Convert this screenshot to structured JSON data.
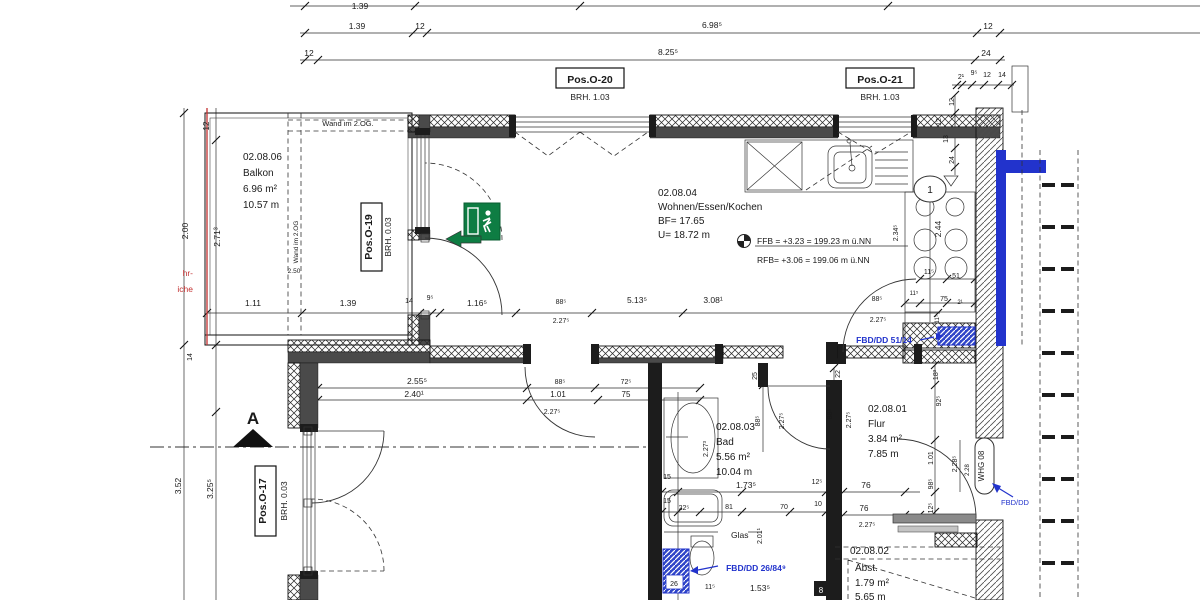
{
  "colors": {
    "black": "#1a1a1a",
    "blue": "#2233cc",
    "red": "#c23030",
    "green": "#0e7d43",
    "white": "#ffffff",
    "wall_dark": "#4a4a4a"
  },
  "rooms": {
    "balkon": {
      "id": "02.08.06",
      "name": "Balkon",
      "area": "6.96 m²",
      "perimeter": "10.57 m"
    },
    "wohnen": {
      "id": "02.08.04",
      "name": "Wohnen/Essen/Kochen",
      "bf": "BF= 17.65",
      "u": "U= 18.72 m"
    },
    "bad": {
      "id": "02.08.03",
      "name": "Bad",
      "area": "5.56 m²",
      "perimeter": "10.04 m"
    },
    "flur": {
      "id": "02.08.01",
      "name": "Flur",
      "area": "3.84 m²",
      "perimeter": "7.85 m"
    },
    "abst": {
      "id": "02.08.02",
      "name": "Abst.",
      "area": "1.79 m²",
      "perimeter": "5.65 m"
    }
  },
  "levels": {
    "ffb": "FFB = +3.23 = 199.23 m ü.NN",
    "rfb": "RFB= +3.06 = 199.06 m ü.NN"
  },
  "pos": {
    "o20": {
      "label": "Pos.O-20",
      "brh": "BRH. 1.03"
    },
    "o21": {
      "label": "Pos.O-21",
      "brh": "BRH. 1.03"
    },
    "o19": {
      "label": "Pos.O-19",
      "brh": "BRH. 0.03"
    },
    "o17": {
      "label": "Pos.O-17",
      "brh": "BRH. 0.03"
    }
  },
  "tags": {
    "whg": "WHG 08",
    "section": "A",
    "glas": "Glas",
    "wand2og_h": "Wand im 2.OG.",
    "wand2og_v": "Wand im 2.OG",
    "red1": "hr-",
    "red2": "iche",
    "detail": "1",
    "chip26": "26",
    "chip8": "8"
  },
  "blue_labels": {
    "fbd1": "FBD/DD 51/14",
    "fbd2": "FBD/DD 26/84⁹",
    "fbd3": "FBD/DD"
  },
  "labels": [
    {
      "t": "1.39",
      "x": 360,
      "y": 9
    },
    {
      "t": "1.39",
      "x": 357,
      "y": 29
    },
    {
      "t": "12",
      "x": 420,
      "y": 29
    },
    {
      "t": "6.98⁵",
      "x": 712,
      "y": 28
    },
    {
      "t": "12",
      "x": 988,
      "y": 29
    },
    {
      "t": "12",
      "x": 309,
      "y": 56
    },
    {
      "t": "8.25⁵",
      "x": 668,
      "y": 55
    },
    {
      "t": "24",
      "x": 986,
      "y": 56
    },
    {
      "t": "2¹",
      "x": 961,
      "y": 79,
      "s": 7
    },
    {
      "t": "9⁵",
      "x": 974,
      "y": 75,
      "s": 7
    },
    {
      "t": "12",
      "x": 987,
      "y": 77,
      "s": 7
    },
    {
      "t": "14",
      "x": 1002,
      "y": 77,
      "s": 7
    },
    {
      "t": "12",
      "x": 954,
      "y": 102,
      "r": -90,
      "s": 7
    },
    {
      "t": "12",
      "x": 941,
      "y": 122,
      "r": -90,
      "s": 7
    },
    {
      "t": "13",
      "x": 948,
      "y": 139,
      "r": -90,
      "s": 7
    },
    {
      "t": "24",
      "x": 954,
      "y": 160,
      "r": -90,
      "s": 7
    },
    {
      "t": "12",
      "x": 209,
      "y": 126,
      "r": -90,
      "s": 8
    },
    {
      "t": "2.71³",
      "x": 220,
      "y": 237,
      "r": -90
    },
    {
      "t": "2.00",
      "x": 188,
      "y": 231,
      "r": -90
    },
    {
      "t": "14",
      "x": 192,
      "y": 357,
      "r": -90,
      "s": 7
    },
    {
      "t": "3.52",
      "x": 181,
      "y": 486,
      "r": -90
    },
    {
      "t": "3.25⁵",
      "x": 213,
      "y": 489,
      "r": -90
    },
    {
      "t": "2.50",
      "x": 294,
      "y": 273,
      "s": 6.5
    },
    {
      "t": "1.11",
      "x": 253,
      "y": 306
    },
    {
      "t": "1.39",
      "x": 348,
      "y": 306
    },
    {
      "t": "14",
      "x": 409,
      "y": 303,
      "s": 7
    },
    {
      "t": "9⁵",
      "x": 430,
      "y": 300,
      "s": 7
    },
    {
      "t": "1.16⁵",
      "x": 477,
      "y": 306
    },
    {
      "t": "88⁵",
      "x": 561,
      "y": 304,
      "s": 7
    },
    {
      "t": "2.27⁵",
      "x": 561,
      "y": 323,
      "s": 7
    },
    {
      "t": "5.13⁵",
      "x": 637,
      "y": 303
    },
    {
      "t": "3.08¹",
      "x": 713,
      "y": 303
    },
    {
      "t": "88⁵",
      "x": 877,
      "y": 301,
      "s": 7
    },
    {
      "t": "2.27⁵",
      "x": 878,
      "y": 322,
      "s": 7
    },
    {
      "t": "2.55⁵",
      "x": 417,
      "y": 384
    },
    {
      "t": "2.40¹",
      "x": 414,
      "y": 397
    },
    {
      "t": "88⁵",
      "x": 560,
      "y": 384,
      "s": 7
    },
    {
      "t": "1.01",
      "x": 558,
      "y": 397,
      "s": 8
    },
    {
      "t": "2.27⁵",
      "x": 552,
      "y": 414,
      "s": 7
    },
    {
      "t": "72⁵",
      "x": 626,
      "y": 384,
      "s": 7
    },
    {
      "t": "75",
      "x": 626,
      "y": 397,
      "s": 8
    },
    {
      "t": "25",
      "x": 757,
      "y": 376,
      "r": -90,
      "s": 7
    },
    {
      "t": "22",
      "x": 840,
      "y": 374,
      "r": -90,
      "s": 7
    },
    {
      "t": "88⁵",
      "x": 760,
      "y": 421,
      "r": -90,
      "s": 7
    },
    {
      "t": "2.27⁵",
      "x": 784,
      "y": 421,
      "r": -90,
      "s": 7
    },
    {
      "t": "88⁵",
      "x": 832,
      "y": 414,
      "r": -90,
      "s": 7
    },
    {
      "t": "2.27⁵",
      "x": 851,
      "y": 420,
      "r": -90,
      "s": 7
    },
    {
      "t": "2.27³",
      "x": 708,
      "y": 449,
      "r": -90,
      "s": 7
    },
    {
      "t": "15",
      "x": 667,
      "y": 479,
      "s": 7
    },
    {
      "t": "15",
      "x": 667,
      "y": 503,
      "s": 7
    },
    {
      "t": "22⁵",
      "x": 684,
      "y": 510,
      "s": 7
    },
    {
      "t": "1.73⁵",
      "x": 746,
      "y": 488
    },
    {
      "t": "81",
      "x": 729,
      "y": 509,
      "s": 7
    },
    {
      "t": "70",
      "x": 784,
      "y": 509,
      "s": 7
    },
    {
      "t": "12⁵",
      "x": 817,
      "y": 484,
      "s": 7
    },
    {
      "t": "10",
      "x": 818,
      "y": 506,
      "s": 7
    },
    {
      "t": "11⁵",
      "x": 710,
      "y": 589,
      "s": 7
    },
    {
      "t": "1.53⁵",
      "x": 760,
      "y": 591
    },
    {
      "t": "2.01¹",
      "x": 762,
      "y": 536,
      "r": -90,
      "s": 7
    },
    {
      "t": "76",
      "x": 866,
      "y": 488
    },
    {
      "t": "76",
      "x": 864,
      "y": 511,
      "s": 8
    },
    {
      "t": "2.27⁵",
      "x": 867,
      "y": 527,
      "s": 7
    },
    {
      "t": "18³",
      "x": 938,
      "y": 375,
      "r": -90,
      "s": 7
    },
    {
      "t": "92⁵",
      "x": 941,
      "y": 401,
      "r": -90,
      "s": 7
    },
    {
      "t": "1.01",
      "x": 933,
      "y": 458,
      "r": -90,
      "s": 7
    },
    {
      "t": "98⁵",
      "x": 933,
      "y": 484,
      "r": -90,
      "s": 7
    },
    {
      "t": "2.28⁵",
      "x": 957,
      "y": 464,
      "r": -90,
      "s": 7
    },
    {
      "t": "2.28",
      "x": 969,
      "y": 470,
      "r": -90,
      "s": 6
    },
    {
      "t": "12⁵",
      "x": 933,
      "y": 508,
      "r": -90,
      "s": 7
    },
    {
      "t": "2.44",
      "x": 941,
      "y": 229,
      "r": -90
    },
    {
      "t": "2.34⁵",
      "x": 898,
      "y": 233,
      "r": -90,
      "s": 7
    },
    {
      "t": "11⁵",
      "x": 929,
      "y": 274,
      "s": 7
    },
    {
      "t": "51",
      "x": 956,
      "y": 278,
      "s": 7
    },
    {
      "t": "75",
      "x": 944,
      "y": 301,
      "s": 7
    },
    {
      "t": "2¹",
      "x": 960,
      "y": 304,
      "s": 6
    },
    {
      "t": "11⁵",
      "x": 914,
      "y": 295,
      "s": 6
    },
    {
      "t": "11⁵",
      "x": 939,
      "y": 319,
      "r": -90,
      "s": 6
    }
  ]
}
